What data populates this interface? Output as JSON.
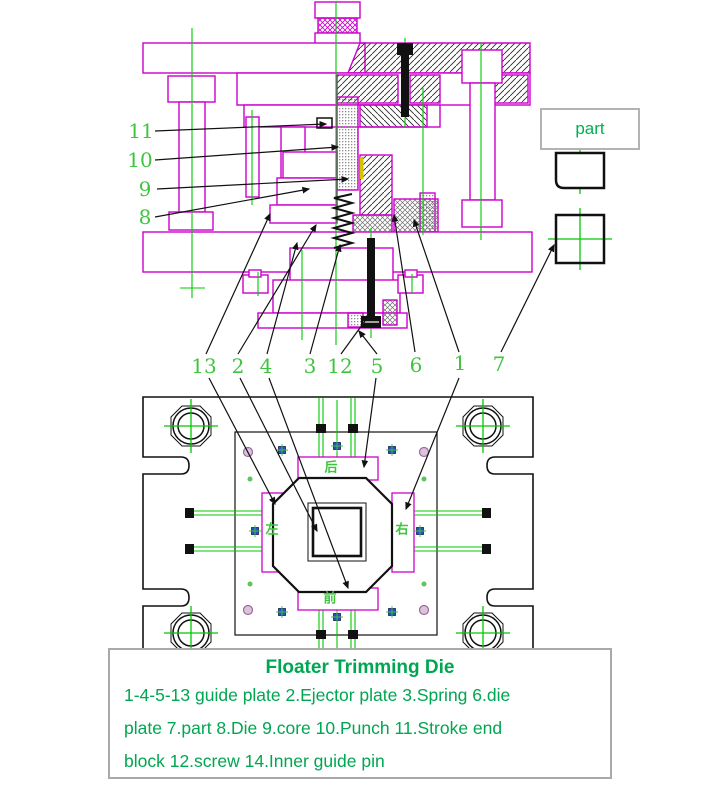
{
  "drawing": {
    "caption": {
      "title": "Floater Trimming Die",
      "lines": [
        "1-4-5-13  guide plate 2.Ejector plate  3.Spring  6.die",
        "plate 7.part  8.Die  9.core  10.Punch  11.Stroke end",
        "block  12.screw  14.Inner guide pin"
      ]
    },
    "part_label": "part",
    "callouts_left": [
      "11",
      "10",
      "9",
      "8"
    ],
    "callouts_middle": [
      "13",
      "2",
      "4",
      "3",
      "12",
      "5",
      "6",
      "1",
      "7"
    ],
    "plan_labels": {
      "top": "后",
      "left": "左",
      "right": "右",
      "bottom": "前"
    },
    "colors": {
      "magenta_line": "#cc00cc",
      "green_line": "#00c800",
      "label_green": "#3fc43f",
      "caption_green": "#00a651",
      "black_line": "#111111",
      "yellow_mark": "#d4c400",
      "blue_fastener": "#2a4fc0",
      "box_border_gray": "#b3b3b3"
    }
  }
}
